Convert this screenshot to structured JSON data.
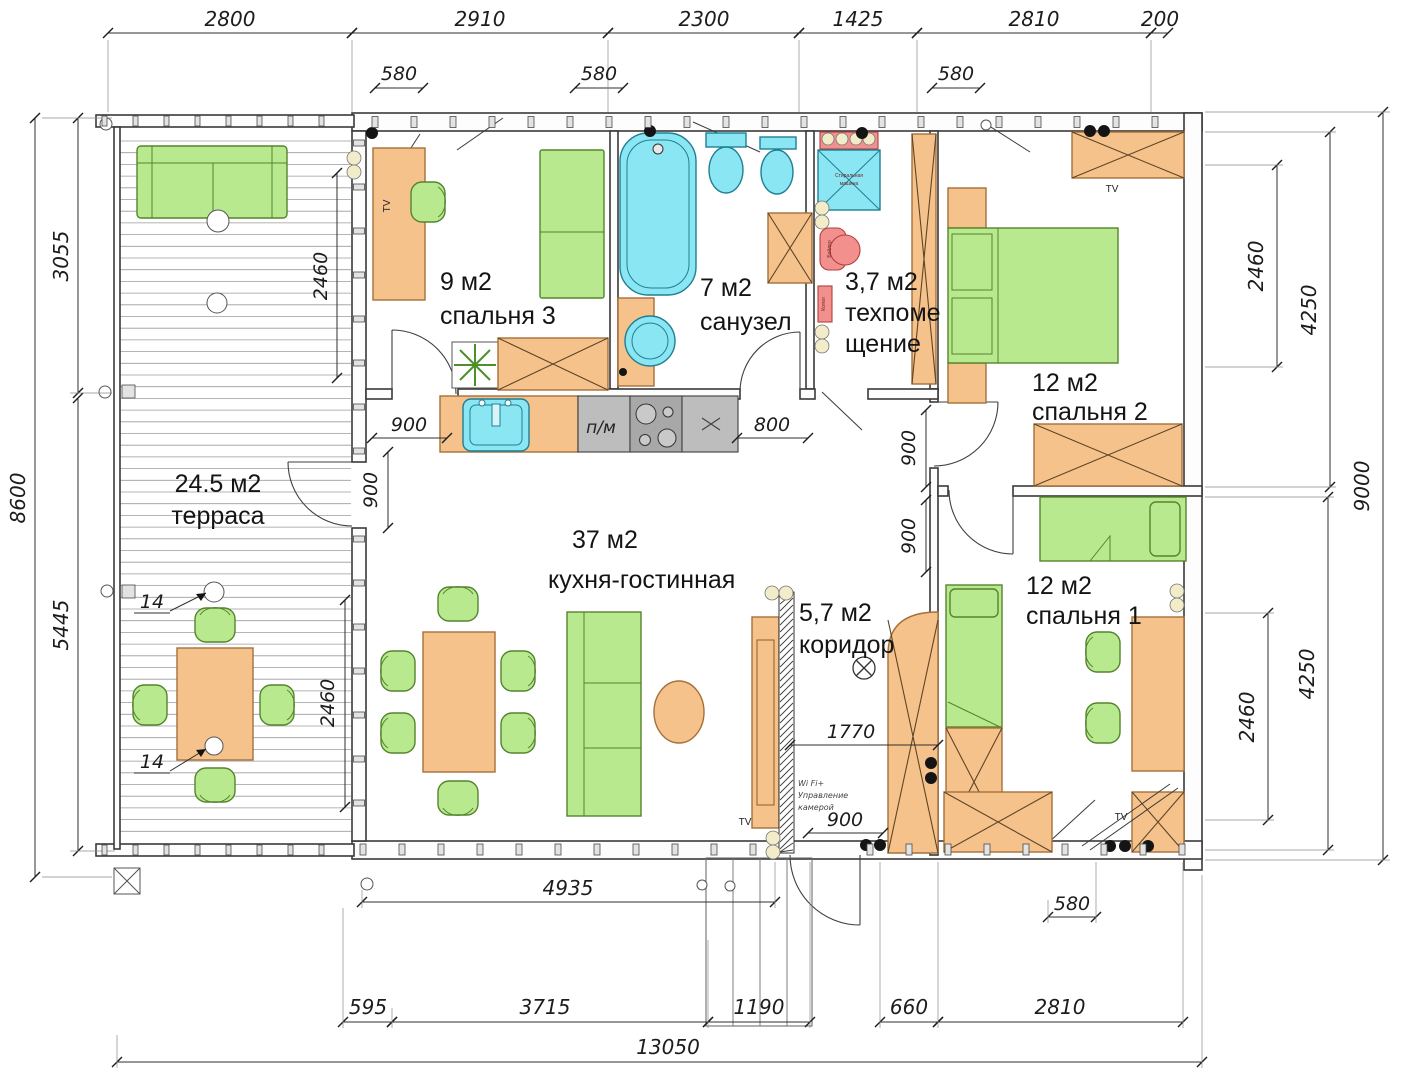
{
  "dims": {
    "top": [
      "2800",
      "2910",
      "2300",
      "1425",
      "2810",
      "200"
    ],
    "top_sub": [
      "580",
      "580",
      "580"
    ],
    "left": [
      "3055",
      "8600",
      "5445"
    ],
    "right": [
      "2460",
      "4250",
      "9000"
    ],
    "right_lower": [
      "2460",
      "4250"
    ],
    "bottom": [
      "4935",
      "580",
      "595",
      "3715",
      "1190",
      "660",
      "2810",
      "13050"
    ],
    "inner": [
      "2460",
      "900",
      "900",
      "2460",
      "800",
      "900",
      "900",
      "1770",
      "900"
    ],
    "callout": "14"
  },
  "rooms": {
    "terrace": {
      "area": "24.5 м2",
      "name": "терраса"
    },
    "bedroom3": {
      "area": "9 м2",
      "name": "спальня 3"
    },
    "bathroom": {
      "area": "7 м2",
      "name": "санузел"
    },
    "tech": {
      "area": "3,7 м2",
      "name1": "техпоме",
      "name2": "щение"
    },
    "bedroom2": {
      "area": "12 м2",
      "name": "спальня 2"
    },
    "living": {
      "area": "37 м2",
      "name": "кухня-гостинная"
    },
    "corridor": {
      "area": "5,7 м2",
      "name": "коридор"
    },
    "bedroom1": {
      "area": "12 м2",
      "name": "спальня 1"
    }
  },
  "labels": {
    "tv": "TV",
    "dishwasher": "п/м",
    "wifi1": "Wi Fi+",
    "wifi2": "Управление",
    "wifi3": "камерой",
    "washer1": "Стиральная",
    "washer2": "машина",
    "boiler": "Бойлер",
    "heater": "Котел"
  },
  "colors": {
    "furniture_green": "#b9e98f",
    "furniture_orange": "#f6c28b",
    "fixture_cyan": "#8ae6f2",
    "appliance_gray": "#bdbdbd",
    "appliance_red": "#f2908e",
    "wall_stroke": "#3a3a3a"
  }
}
